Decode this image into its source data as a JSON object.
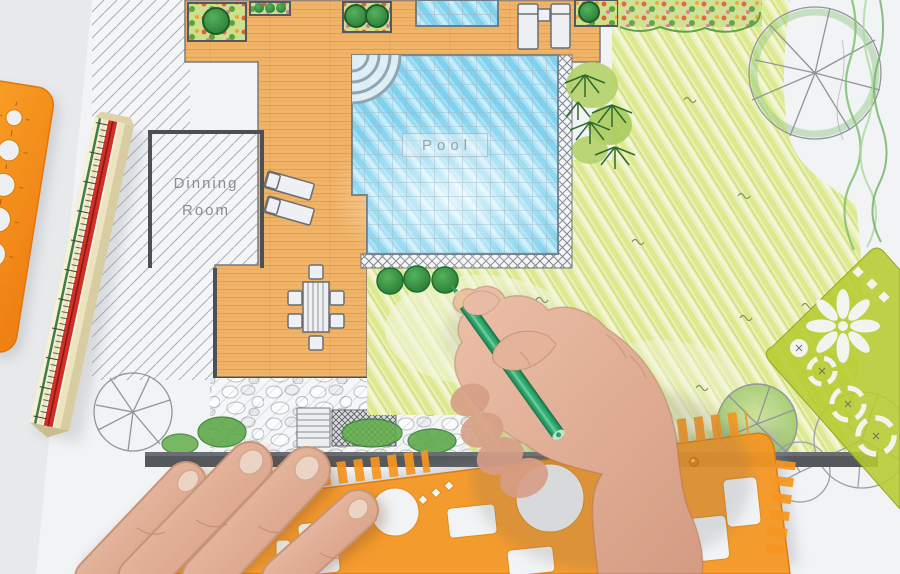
{
  "scene": {
    "type": "photograph",
    "subject": "Landscape architect hand-drawing a backyard garden design plan in colored pencil",
    "plan_labels": {
      "pool": "Pool",
      "dining_room_line1": "Dinning",
      "dining_room_line2": "Room"
    },
    "plan_areas": [
      "wood deck",
      "swimming pool with steps",
      "spa",
      "lawn",
      "flower beds",
      "ferns",
      "stone pebble path",
      "dining room",
      "tree symbols",
      "retaining wall"
    ],
    "tools": [
      "triangular scale ruler",
      "orange circle template stencil",
      "orange drafting stencil",
      "green flower/landscape stencil",
      "green colored pencil"
    ],
    "hands": [
      "left hand holding drafting stencil",
      "right hand drawing bushes with green pencil"
    ]
  },
  "palette": {
    "paper": "#f2f3f5",
    "desk": "#e7e9eb",
    "deck_wood": "#f2b469",
    "pool_water": "#8fd8f1",
    "lawn": "#e4ecab",
    "stencil_orange": "#f79a20",
    "stencil_green": "#b6cb30",
    "pencil_green": "#2ea46c",
    "skin": "#dfa88f",
    "retaining_wall": "#54575c",
    "plan_line": "#4c4f54"
  }
}
